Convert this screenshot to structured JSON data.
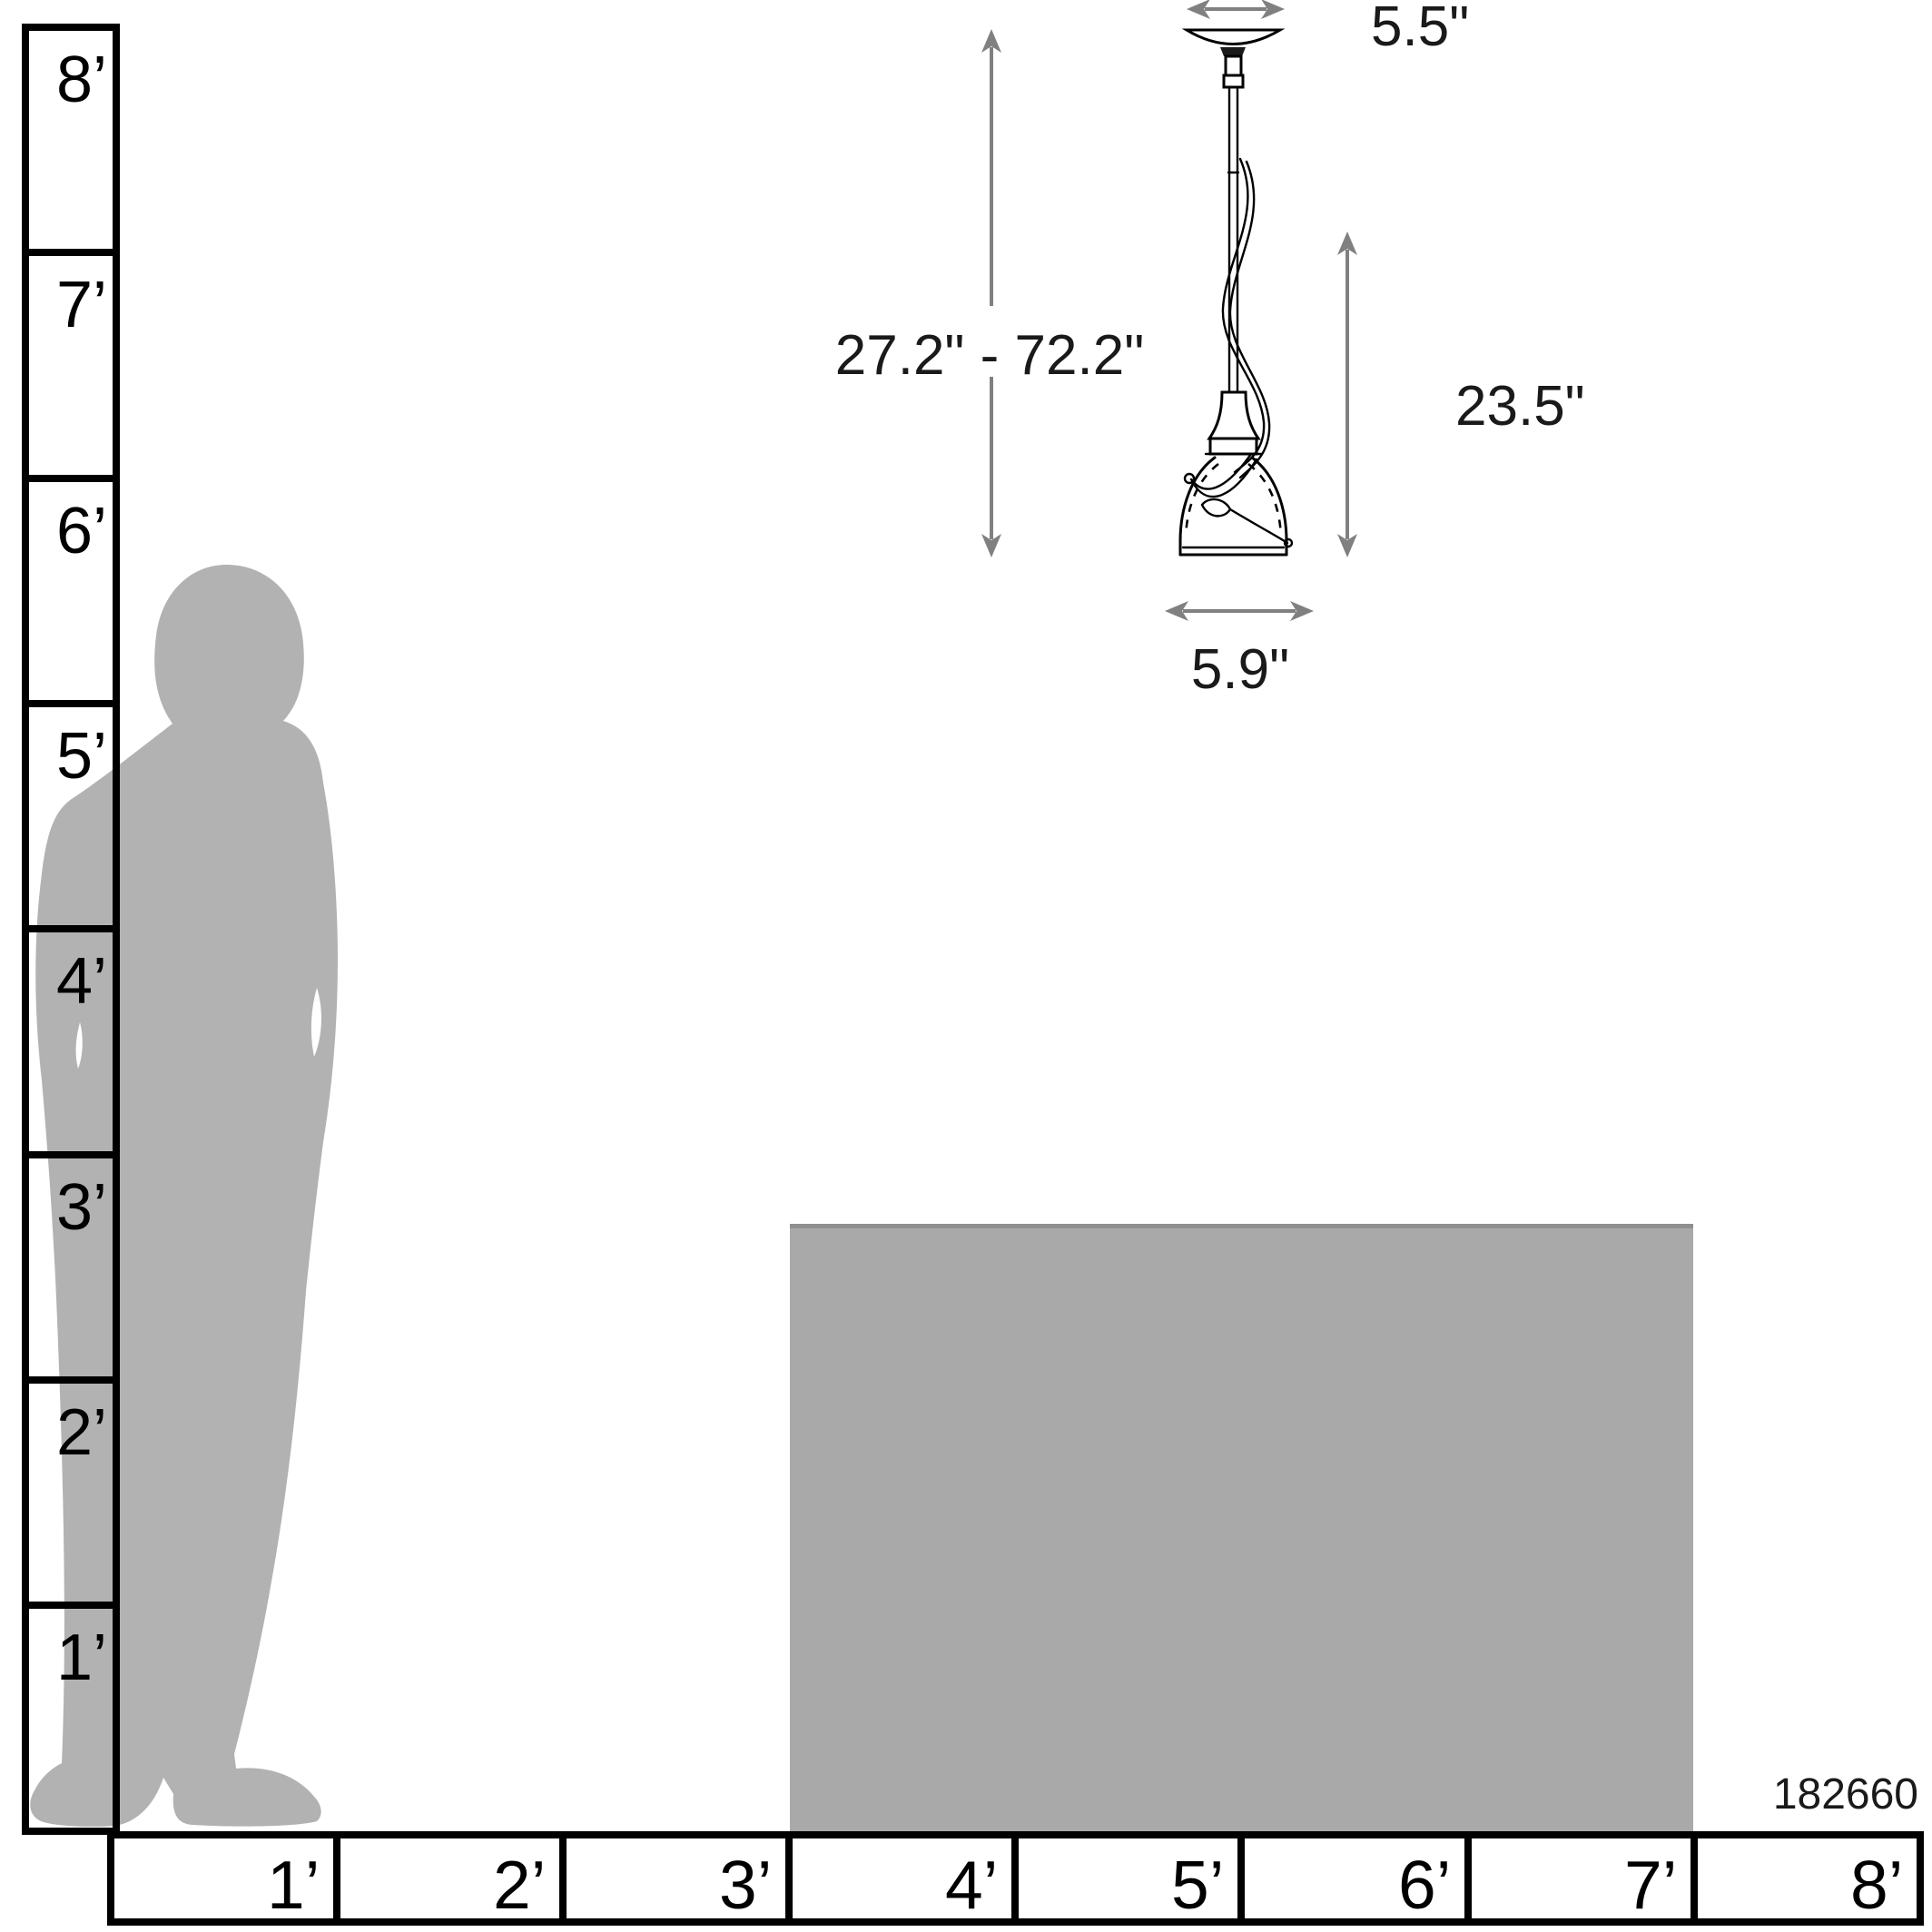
{
  "product": {
    "number": "182660"
  },
  "pendant": {
    "dimension_labels": {
      "canopy_width": "5.5\"",
      "hanging_height_range": "27.2\" - 72.2\"",
      "fixture_height": "23.5\"",
      "shade_width": "5.9\""
    }
  },
  "rulers": {
    "vertical_feet": {
      "labels": [
        "8’",
        "7’",
        "6’",
        "5’",
        "4’",
        "3’",
        "2’",
        "1’"
      ]
    },
    "horizontal_feet": {
      "labels": [
        "1’",
        "2’",
        "3’",
        "4’",
        "5’",
        "6’",
        "7’",
        "8’"
      ]
    }
  },
  "colors": {
    "silhouette": "#b2b2b2",
    "table": "#a9a9a9",
    "table_edge": "#8f8f8f",
    "dimension": "#808080",
    "outline": "#000000"
  }
}
